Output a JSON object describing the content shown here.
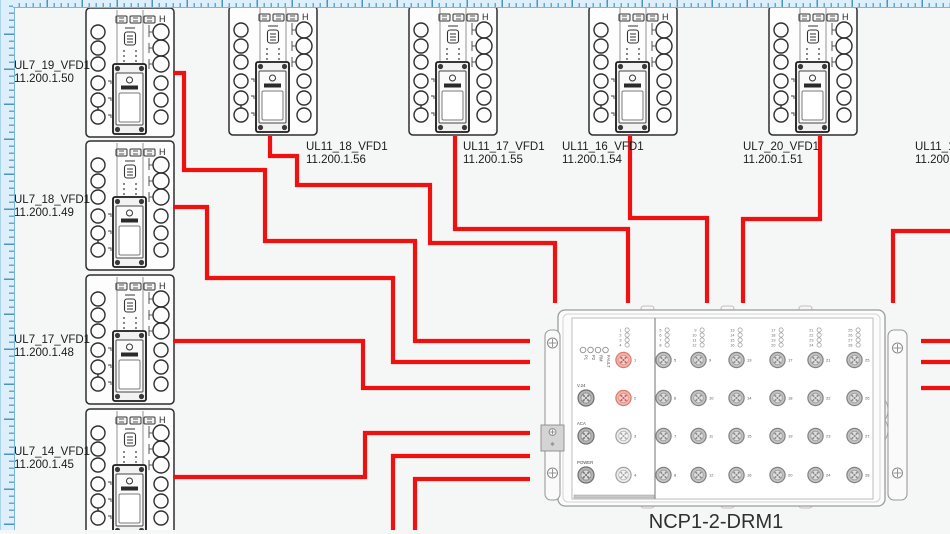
{
  "colors": {
    "cable": "#ef1010",
    "canvas_bg": "#f5f6f6",
    "ruler_fill": "#dceffa",
    "ruler_line": "#79b6da",
    "port_styles": {
      "pink": {
        "ring": "#f0b3aa",
        "edge": "#d97b6f",
        "face": "#f6cfc9",
        "inner": "#dd9288",
        "pins": "#c4625a"
      },
      "gray": {
        "ring": "#c2c2c2",
        "edge": "#808080",
        "face": "#e0e0e0",
        "inner": "#9e9e9e",
        "pins": "#8c8c8c"
      },
      "light": {
        "ring": "#ececec",
        "edge": "#a0a0a0",
        "face": "#f6f6f6",
        "inner": "#b5b5b5",
        "pins": "#ababab"
      },
      "dark": {
        "ring": "#b5b5b5",
        "edge": "#6e6e6e",
        "face": "#dcdcdc",
        "inner": "#8f8f8f",
        "pins": "#777777"
      }
    }
  },
  "vfd_corner_mark": "H",
  "devices": [
    {
      "name": "UL7_19_VFD1",
      "ip": "11.200.1.50",
      "x": 85,
      "y": 7,
      "lx": 14,
      "ly": 60
    },
    {
      "name": "UL7_18_VFD1",
      "ip": "11.200.1.49",
      "x": 85,
      "y": 140,
      "lx": 14,
      "ly": 194
    },
    {
      "name": "UL7_17_VFD1",
      "ip": "11.200.1.48",
      "x": 85,
      "y": 274,
      "lx": 14,
      "ly": 334
    },
    {
      "name": "UL7_14_VFD1",
      "ip": "11.200.1.45",
      "x": 85,
      "y": 408,
      "lx": 14,
      "ly": 446
    },
    {
      "name": "UL11_18_VFD1",
      "ip": "11.200.1.56",
      "x": 228,
      "y": 5,
      "lx": 306,
      "ly": 141
    },
    {
      "name": "UL11_17_VFD1",
      "ip": "11.200.1.55",
      "x": 408,
      "y": 5,
      "lx": 463,
      "ly": 141
    },
    {
      "name": "UL11_16_VFD1",
      "ip": "11.200.1.54",
      "x": 588,
      "y": 5,
      "lx": 562,
      "ly": 141
    },
    {
      "name": "UL7_20_VFD1",
      "ip": "11.200.1.51",
      "x": 768,
      "y": 5,
      "lx": 743,
      "ly": 141
    },
    {
      "name": "UL11_14",
      "ip": "11.200.1",
      "x": null,
      "y": null,
      "lx": 915,
      "ly": 141
    }
  ],
  "drm": {
    "label": "NCP1-2-DRM1",
    "x": 541,
    "y": 308,
    "status_leds": [
      "P1",
      "P2",
      "RM",
      "FAULT"
    ],
    "side_ports": [
      "V.24",
      "ACA",
      "POWER"
    ],
    "port_columns": [
      [
        1,
        2,
        3,
        4
      ],
      [
        5,
        6,
        7,
        8
      ],
      [
        9,
        10,
        11,
        12
      ],
      [
        13,
        14,
        15,
        16
      ],
      [
        17,
        18,
        19,
        20
      ],
      [
        21,
        22,
        23,
        24
      ],
      [
        25,
        26,
        27,
        28
      ]
    ],
    "highlighted_ports": [
      1,
      2
    ],
    "col_x": [
      82.5,
      122.5,
      157.5,
      195.5,
      236.5,
      274.5,
      313.5
    ],
    "row_y": [
      52,
      90,
      128,
      167
    ]
  },
  "cables": [
    {
      "from": "UL7_19_VFD1",
      "points": [
        [
          173,
          73
        ],
        [
          184,
          73
        ],
        [
          184,
          170
        ],
        [
          265,
          170
        ],
        [
          265,
          241
        ],
        [
          415,
          241
        ],
        [
          415,
          341
        ],
        [
          530,
          341
        ]
      ]
    },
    {
      "from": "UL7_18_VFD1",
      "points": [
        [
          173,
          207
        ],
        [
          207,
          207
        ],
        [
          207,
          278
        ],
        [
          393,
          278
        ],
        [
          393,
          362
        ],
        [
          530,
          362
        ]
      ]
    },
    {
      "from": "UL7_17_VFD1",
      "points": [
        [
          173,
          341
        ],
        [
          363,
          341
        ],
        [
          363,
          388
        ],
        [
          530,
          388
        ]
      ]
    },
    {
      "from": "UL7_14_VFD1",
      "points": [
        [
          173,
          477
        ],
        [
          365,
          477
        ],
        [
          365,
          433
        ],
        [
          530,
          433
        ]
      ]
    },
    {
      "from": "UL11_18_VFD1",
      "points": [
        [
          270,
          136
        ],
        [
          270,
          156
        ],
        [
          297,
          156
        ],
        [
          297,
          185
        ],
        [
          430,
          185
        ],
        [
          430,
          243
        ],
        [
          555,
          243
        ],
        [
          555,
          303
        ]
      ]
    },
    {
      "from": "UL11_17_VFD1",
      "points": [
        [
          455,
          136
        ],
        [
          455,
          229
        ],
        [
          628,
          229
        ],
        [
          628,
          303
        ]
      ]
    },
    {
      "from": "UL11_16_VFD1",
      "points": [
        [
          630,
          136
        ],
        [
          630,
          218
        ],
        [
          707,
          218
        ],
        [
          707,
          303
        ]
      ]
    },
    {
      "from": "UL7_20_VFD1",
      "points": [
        [
          820,
          136
        ],
        [
          820,
          219
        ],
        [
          743,
          219
        ],
        [
          743,
          303
        ]
      ]
    },
    {
      "from": "UL11_14",
      "points": [
        [
          950,
          231
        ],
        [
          893,
          231
        ],
        [
          893,
          303
        ]
      ]
    },
    {
      "from": "right-stub-1",
      "points": [
        [
          921,
          341
        ],
        [
          950,
          341
        ]
      ]
    },
    {
      "from": "right-stub-2",
      "points": [
        [
          921,
          362
        ],
        [
          950,
          362
        ]
      ]
    },
    {
      "from": "right-stub-3",
      "points": [
        [
          921,
          388
        ],
        [
          950,
          388
        ]
      ]
    },
    {
      "from": "bottom-stub-1",
      "points": [
        [
          530,
          456
        ],
        [
          393,
          456
        ],
        [
          393,
          532
        ]
      ]
    },
    {
      "from": "bottom-stub-2",
      "points": [
        [
          530,
          479
        ],
        [
          415,
          479
        ],
        [
          415,
          532
        ]
      ]
    }
  ]
}
